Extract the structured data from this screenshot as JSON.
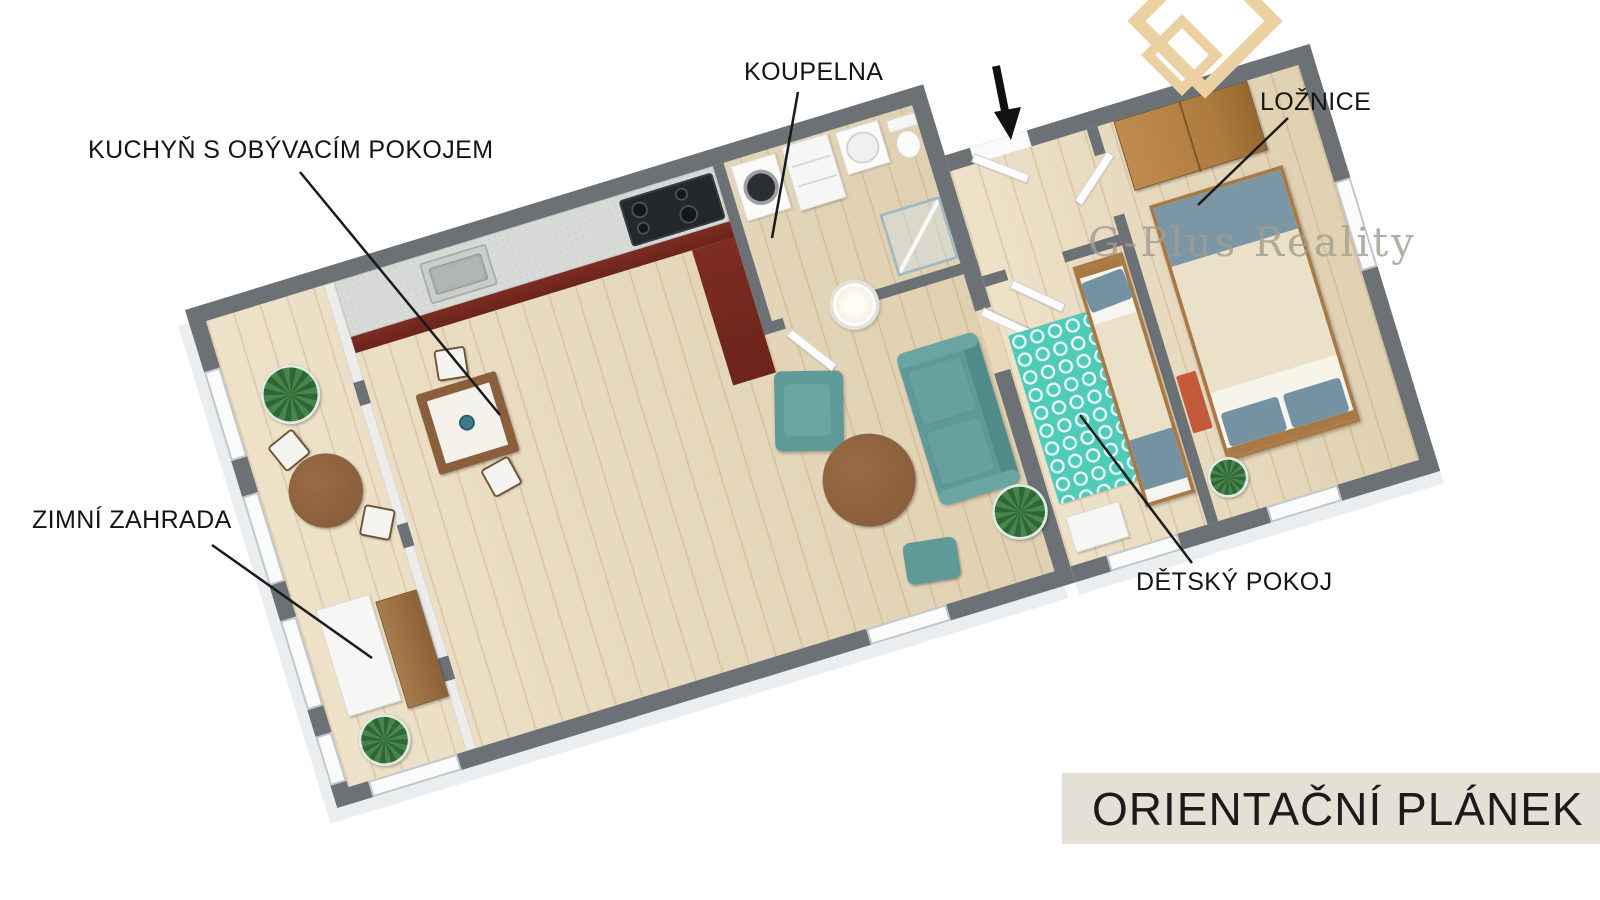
{
  "labels": {
    "kitchen_living": "KUCHYŇ S OBÝVACÍM POKOJEM",
    "bathroom": "KOUPELNA",
    "bedroom": "LOŽNICE",
    "winter_garden": "ZIMNÍ ZAHRADA",
    "kids_room": "DĚTSKÝ POKOJ"
  },
  "banner": {
    "text": "ORIENTAČNÍ PLÁNEK"
  },
  "watermark": {
    "text": "G-Plus Reality"
  },
  "colors": {
    "wall": "#6c7176",
    "floor": "#e9d9b9",
    "banner_bg": "#e5e0d5",
    "banner_text": "#1b1b1b",
    "label_text": "#141414",
    "teal": "#5e9a98",
    "rug_teal": "#4fcbba",
    "wood": "#8b5f3c",
    "cabinet_red": "#7d2c22",
    "counter": "#d7dad7",
    "bed_blue": "#7592a2",
    "bed_cream": "#ebe1c9",
    "wardrobe_wood": "#c08b4e",
    "accent_orange": "#c35a3c",
    "logo_beige": "#ebd0a2",
    "watermark_gray": "#a29c90",
    "leader_line": "#1a1a1a"
  }
}
